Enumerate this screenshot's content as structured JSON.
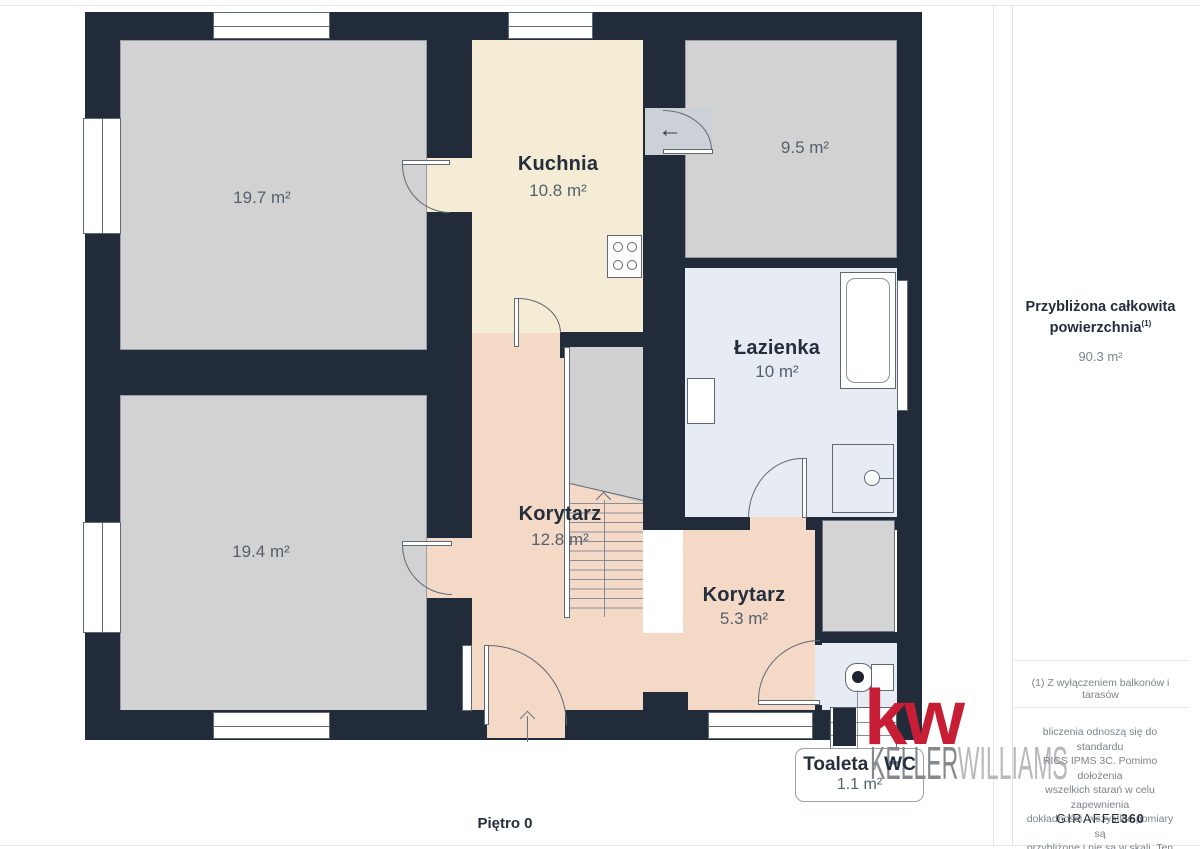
{
  "floorplan": {
    "level_label": "Piętro 0",
    "rooms": [
      {
        "name": "",
        "area": "19.7 m²"
      },
      {
        "name": "Kuchnia",
        "area": "10.8 m²"
      },
      {
        "name": "",
        "area": "9.5 m²"
      },
      {
        "name": "Łazienka",
        "area": "10 m²"
      },
      {
        "name": "Korytarz",
        "area": "12.8 m²"
      },
      {
        "name": "",
        "area": "19.4 m²"
      },
      {
        "name": "Korytarz",
        "area": "5.3 m²"
      }
    ],
    "callout": {
      "label_primary": "Toaleta",
      "separator": "/",
      "label_secondary": "WC",
      "area": "1.1 m²"
    },
    "icons": {
      "kitchen_step_arrow": "←"
    }
  },
  "sidebar": {
    "total_area_heading_line1": "Przybliżona całkowita",
    "total_area_heading_line2": "powierzchnia",
    "total_area_footnote_marker": "(1)",
    "total_area_value": "90.3 m²",
    "footnote": "(1) Z wyłączeniem balkonów i tarasów",
    "disclaimer_lines": [
      "bliczenia odnoszą się do standardu",
      "RICS IPMS 3C. Pomimo dołożenia",
      "wszelkich starań w celu zapewnienia",
      "dokładności, wszystkie pomiary są",
      "przybliżone i nie są w skali. Ten plan",
      "piętra ma charakter poglądowy."
    ],
    "brand_footer_name": "GIRAFFE",
    "brand_footer_suffix": "360"
  },
  "branding": {
    "logo_monogram": "kw",
    "logo_name_primary": "KELLER",
    "logo_name_secondary": "WILLIAMS"
  },
  "colors": {
    "wall": "#212b39",
    "room_gray": "#d2d2d2",
    "kitchen_cream": "#f4ecd4",
    "corridor_pink": "#f4d9c7",
    "bath_lavender": "#e7ebf4",
    "kw_red": "#c81e35"
  }
}
